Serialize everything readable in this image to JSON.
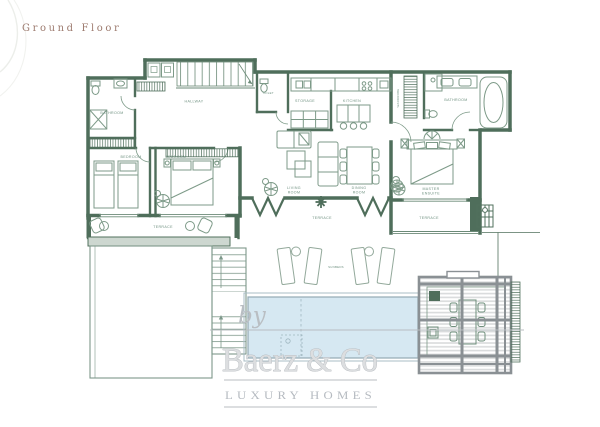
{
  "title": "Ground Floor",
  "rooms": {
    "hallway": "HALLWAY",
    "bathroom_left": "BATHROOM",
    "bedroom_left": "BEDROOM",
    "bedroom_mid": "BEDROOM",
    "toilet": "TOILET",
    "storage": "STORAGE",
    "kitchen": "KITCHEN",
    "wardrobe": "WARDROBE",
    "bathroom_right": "BATHROOM",
    "master_line1": "MASTER",
    "master_line2": "ENSUITE",
    "living_line1": "LIVING",
    "living_line2": "ROOM",
    "dining_line1": "DINING",
    "dining_line2": "ROOM",
    "terrace_left": "TERRACE",
    "terrace_center": "TERRACE",
    "terrace_right": "TERRACE",
    "sunbeds": "SUNBEDS"
  },
  "watermark": {
    "prefix": "by",
    "brand": "Baerz & Co",
    "tagline": "LUXURY HOMES"
  },
  "colors": {
    "wall_green": "#4f6e5b",
    "furniture_green": "#7d9a88",
    "label_green": "#6f9180",
    "pool_fill": "#d6e8f2",
    "pool_edge": "#93aab3",
    "railing_fill": "#cdd7d0",
    "pergola_gray": "#8a9094",
    "slat_gray": "#d9dbdc",
    "watermark_gray": "#c3c7cb",
    "title_color": "#9d7b6f"
  }
}
